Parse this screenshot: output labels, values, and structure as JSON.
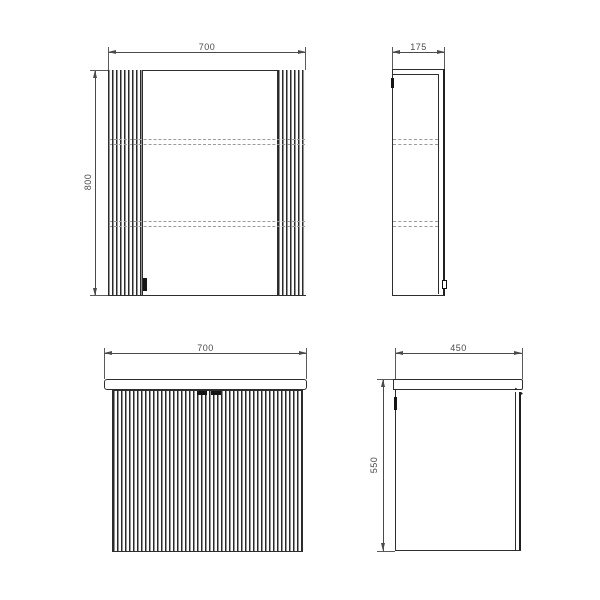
{
  "drawing": {
    "type": "furniture-technical-drawing",
    "views": {
      "mirror_front": {
        "label": "mirror cabinet front view",
        "width_label": "700",
        "height_label": "800"
      },
      "mirror_side": {
        "label": "mirror cabinet side view",
        "depth_label": "175"
      },
      "vanity_front": {
        "label": "vanity unit front view",
        "width_label": "700"
      },
      "vanity_side": {
        "label": "vanity unit side view",
        "depth_label": "450",
        "height_label": "550"
      }
    },
    "colors": {
      "outline": "#2e2e2e",
      "dimension": "#4a4a4a",
      "hidden_line": "#9b9b9b",
      "background": "#ffffff"
    }
  }
}
